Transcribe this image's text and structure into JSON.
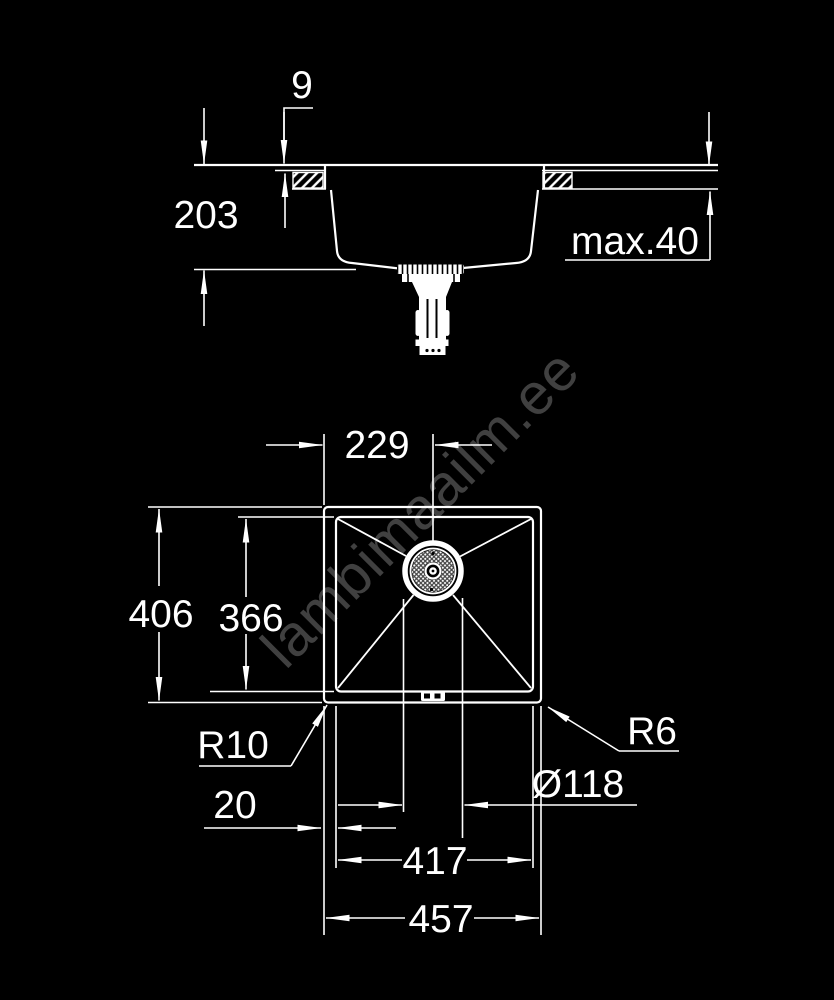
{
  "colors": {
    "background": "#000000",
    "line": "#ffffff"
  },
  "watermark": {
    "text": "lambimaailm.ee"
  },
  "side_view": {
    "label": "sink side section view",
    "dims": {
      "rim_height": "9",
      "bowl_depth": "203",
      "counter_thickness": "max.40"
    }
  },
  "top_view": {
    "label": "sink top plan view",
    "dims": {
      "center_offset": "229",
      "outer_depth": "406",
      "bowl_depth": "366",
      "bowl_corner_radius": "R10",
      "rim_offset": "20",
      "drain_diameter": "Ø118",
      "bowl_width": "417",
      "outer_width": "457",
      "outer_corner_radius": "R6"
    }
  }
}
